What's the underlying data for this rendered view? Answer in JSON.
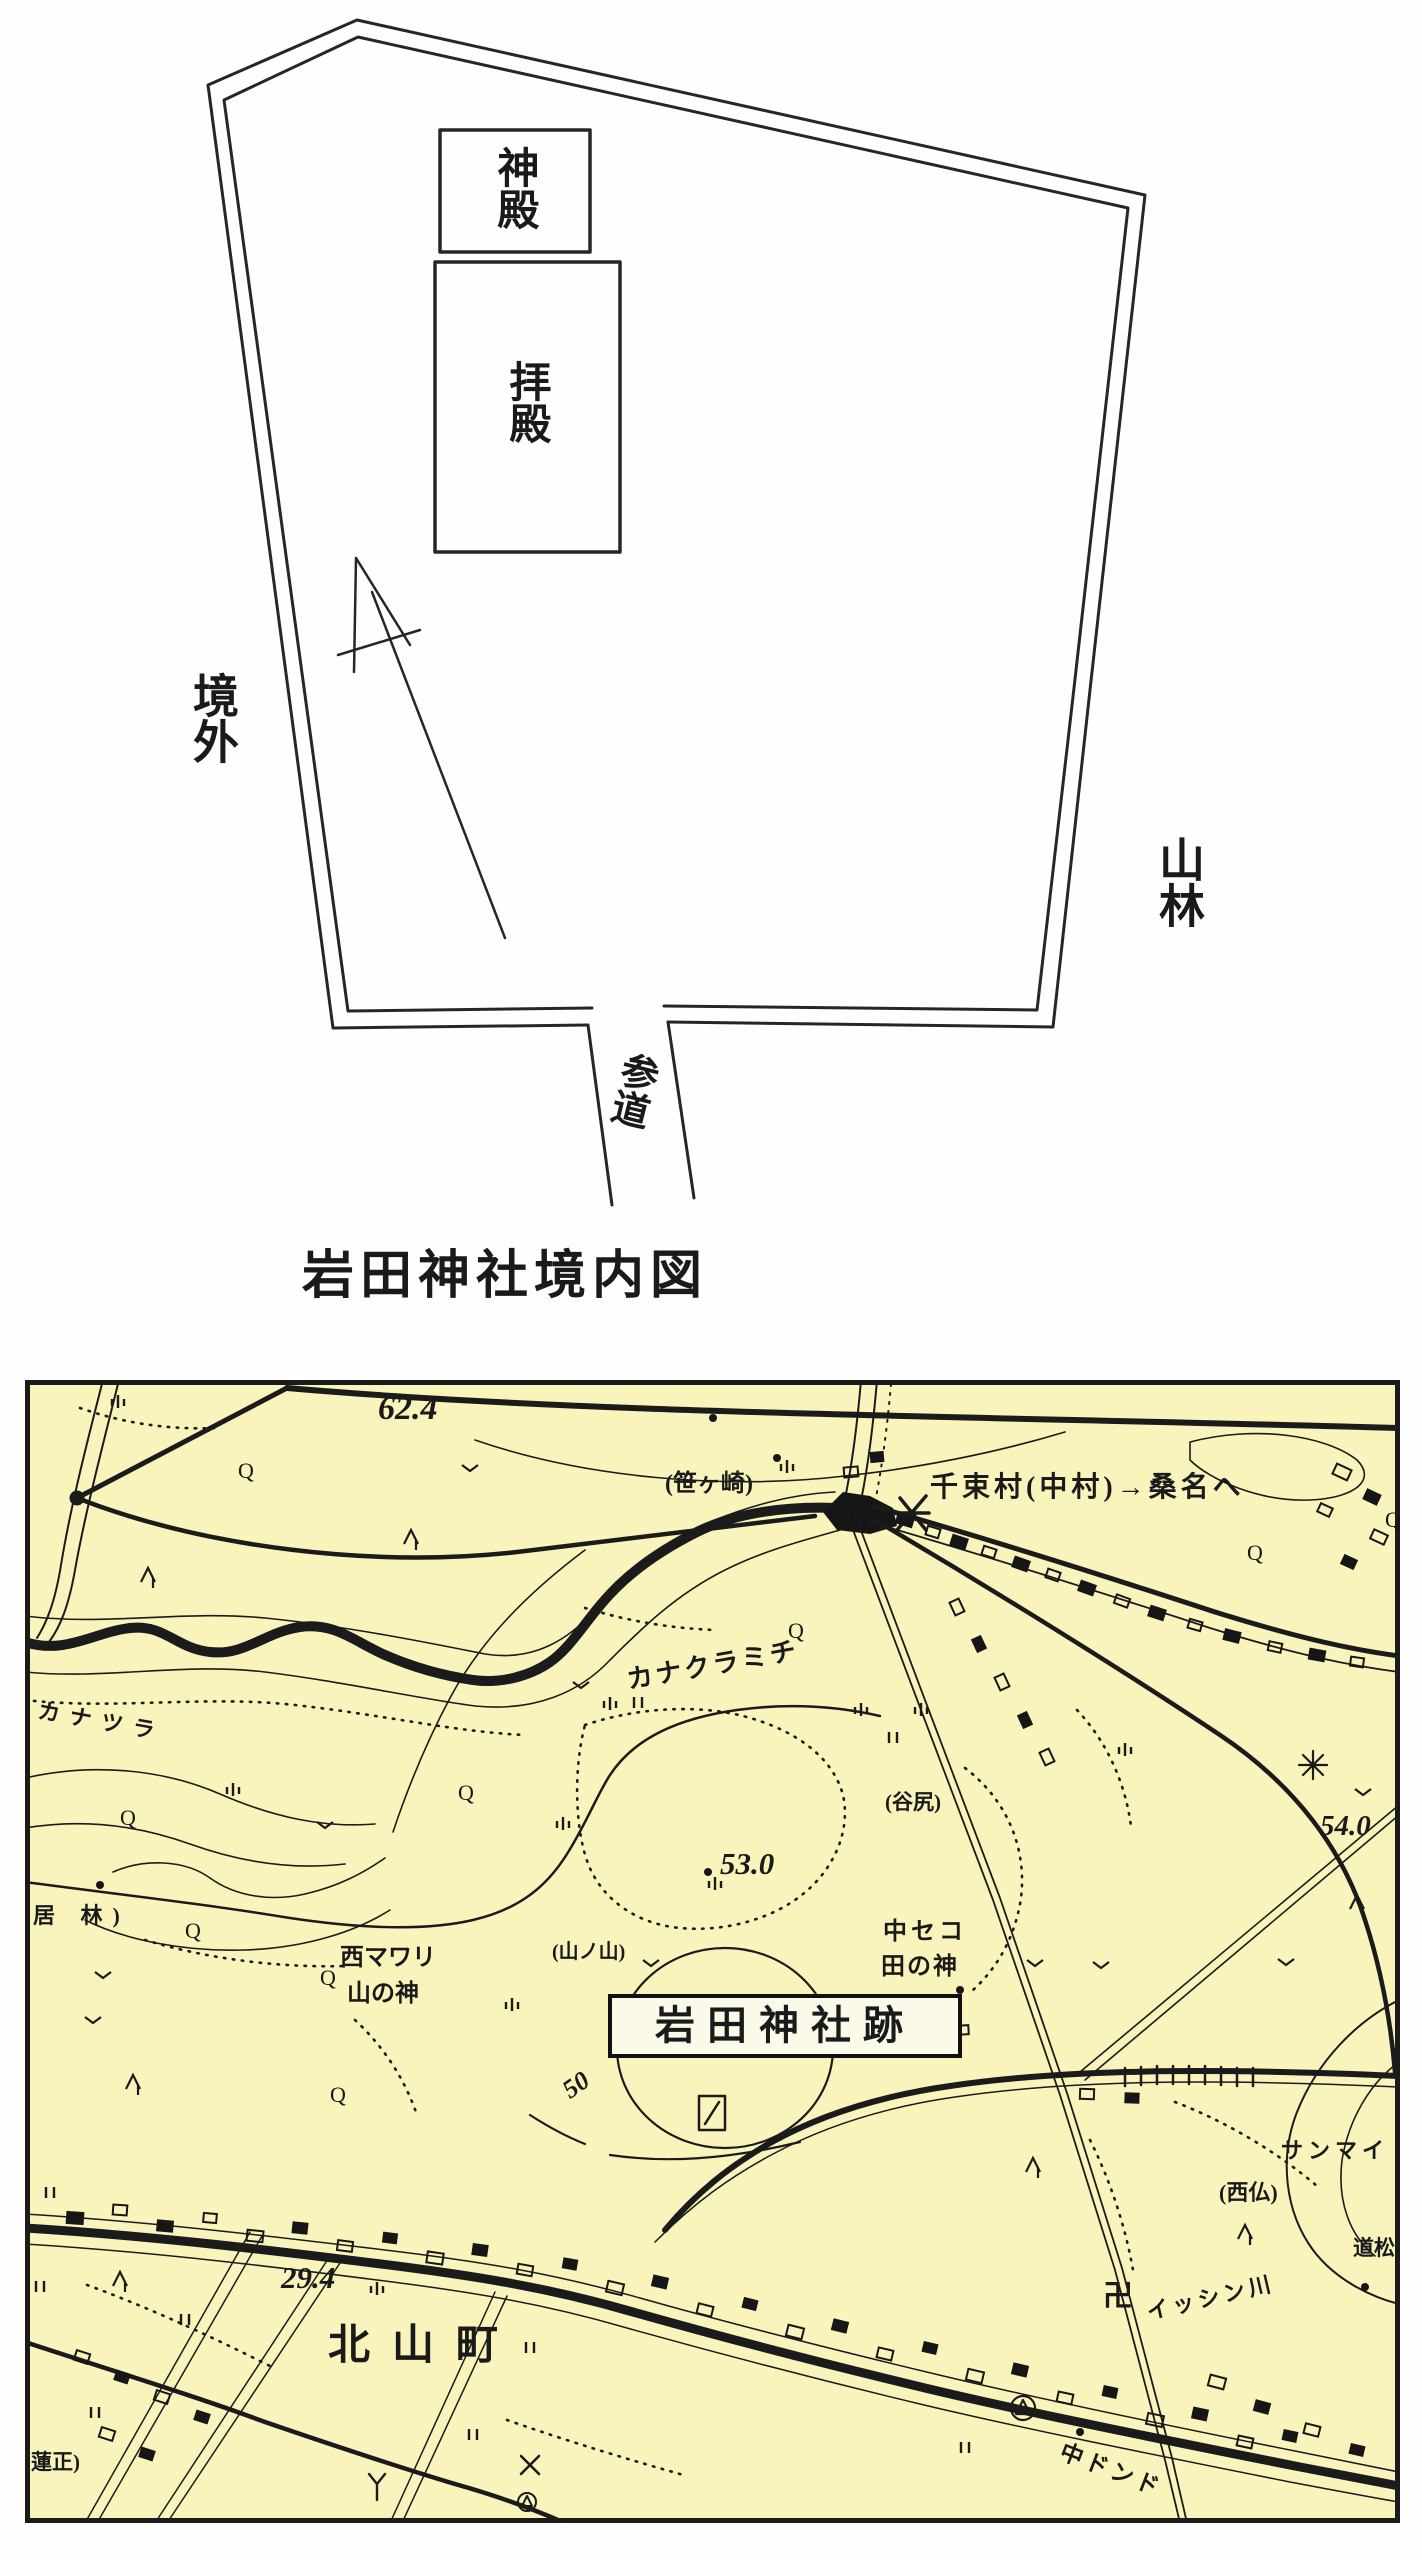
{
  "page": {
    "bg": "#fefefe",
    "ink": "#1c1c1c"
  },
  "precinct_diagram": {
    "caption": "岩田神社境内図",
    "shinden_label": "神殿",
    "haiden_label": "拝殿",
    "outside_label": "境外",
    "forest_label": "山林",
    "approach_label": "参道"
  },
  "topo_map": {
    "bg_color": "#f8f4bc",
    "frame_color": "#1b1b1b",
    "orchard_symbol": "Q",
    "labels": {
      "elev_62_4": "62.4",
      "sasagasaki": "(笹ヶ崎)",
      "road_note": "千束村(中村)→桑名へ",
      "kanakuramichi": "カナクラミチ",
      "elev_53_0": "53.0",
      "tanijiri": "(谷尻)",
      "nakaseko": "中セコ",
      "ta_no_kami": "田の神",
      "shrine_site": "岩田神社跡",
      "nishimawari": "西マワリ",
      "yama_no_kami": "山の神",
      "yamanoyama": "(山ノ山)",
      "ibayashi": "居 林)",
      "contour_50": "50",
      "kanatsura": "カナツラ",
      "elev_29_4": "29.4",
      "kitayama_cho": "北山町",
      "rensho": "蓮正)",
      "manji": "卍",
      "nishibotoke": "(西仏)",
      "isshin_gawa": "イッシン川",
      "domatsu": "道松",
      "sanmai": "サンマイ",
      "naka_dondo": "中ドンド",
      "elev_54_0": "54.0"
    }
  }
}
